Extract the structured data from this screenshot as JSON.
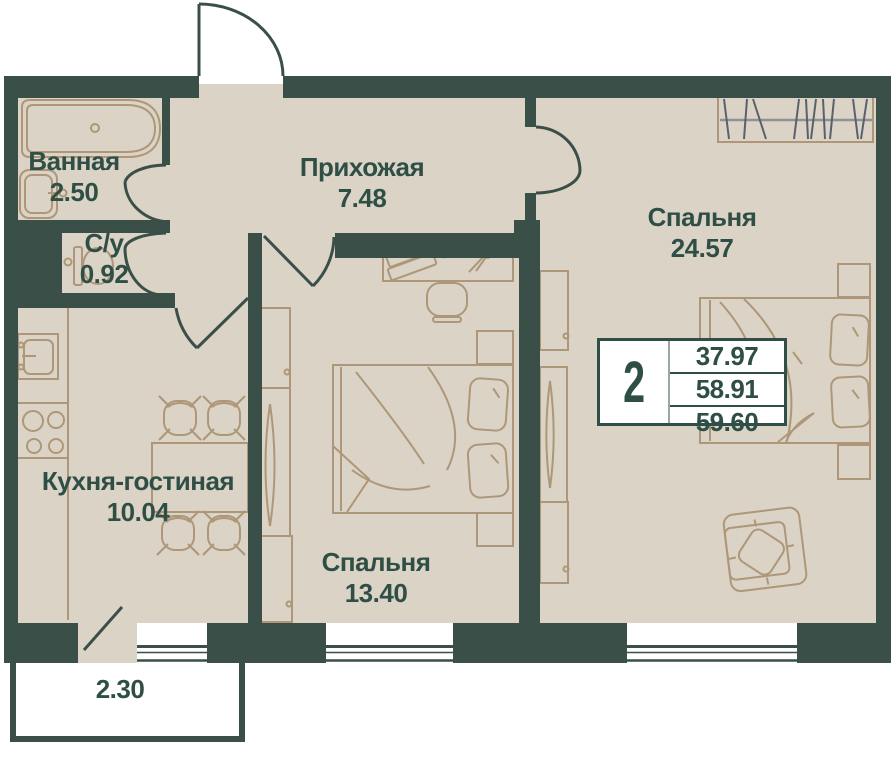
{
  "rooms": [
    {
      "id": "bathroom",
      "name": "Ванная",
      "area": "2.50"
    },
    {
      "id": "wc",
      "name": "С/у",
      "area": "0.92"
    },
    {
      "id": "hallway",
      "name": "Прихожая",
      "area": "7.48"
    },
    {
      "id": "bedroom-master",
      "name": "Спальня",
      "area": "24.57"
    },
    {
      "id": "kitchen-living",
      "name": "Кухня-гостиная",
      "area": "10.04"
    },
    {
      "id": "bedroom",
      "name": "Спальня",
      "area": "13.40"
    }
  ],
  "balcony": {
    "area": "2.30"
  },
  "info_box": {
    "rooms_count": "2",
    "areas": [
      "37.97",
      "58.91",
      "59.60"
    ]
  },
  "colors": {
    "wall": "#394F48",
    "floor": "#DBD3C6",
    "furniture_line": "#AE9778",
    "text": "#2F4F46",
    "hanger_line": "#59616C",
    "window_fill": "#FFFFFF"
  }
}
